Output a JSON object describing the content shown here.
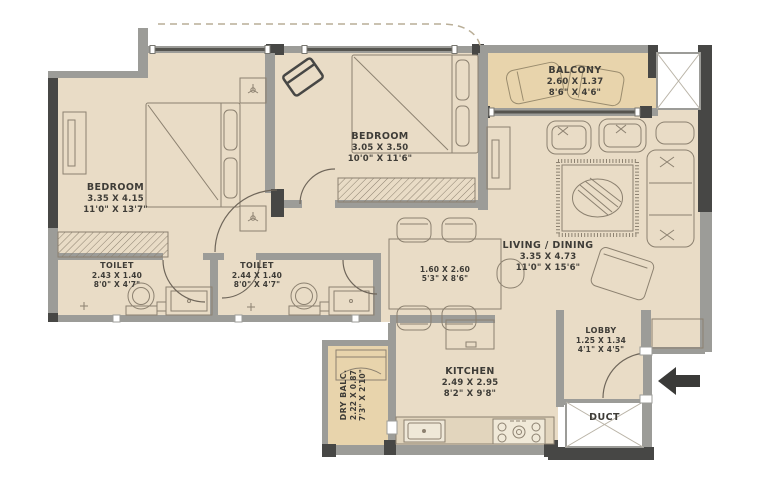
{
  "rooms": {
    "bedroom1": {
      "name": "BEDROOM",
      "dim_m": "3.35 X 4.15",
      "dim_ft": "11'0\" X 13'7\""
    },
    "bedroom2": {
      "name": "BEDROOM",
      "dim_m": "3.05 X 3.50",
      "dim_ft": "10'0\" X 11'6\""
    },
    "balcony": {
      "name": "BALCONY",
      "dim_m": "2.60 X 1.37",
      "dim_ft": "8'6\" X 4'6\""
    },
    "living": {
      "name": "LIVING / DINING",
      "dim_m": "3.35 X 4.73",
      "dim_ft": "11'0\" X 15'6\""
    },
    "toilet1": {
      "name": "TOILET",
      "dim_m": "2.43 X 1.40",
      "dim_ft": "8'0\" X 4'7\""
    },
    "toilet2": {
      "name": "TOILET",
      "dim_m": "2.44 X 1.40",
      "dim_ft": "8'0\" X 4'7\""
    },
    "dining": {
      "dim_m": "1.60 X 2.60",
      "dim_ft": "5'3\" X 8'6\""
    },
    "kitchen": {
      "name": "KITCHEN",
      "dim_m": "2.49 X 2.95",
      "dim_ft": "8'2\" X 9'8\""
    },
    "lobby": {
      "name": "LOBBY",
      "dim_m": "1.25 X 1.34",
      "dim_ft": "4'1\" X 4'5\""
    },
    "dry_balcony": {
      "name": "DRY BALC.",
      "dim_m": "2.22 X 0.87",
      "dim_ft": "7'3\" X 2'10\""
    },
    "duct": {
      "name": "DUCT"
    }
  },
  "colors": {
    "floor": "#e9dcc6",
    "balcony_floor": "#e8d4ac",
    "wall": "#9c9c98",
    "wall_dark": "#474745",
    "furniture_line": "#8c8170",
    "text": "#3e3c37"
  }
}
